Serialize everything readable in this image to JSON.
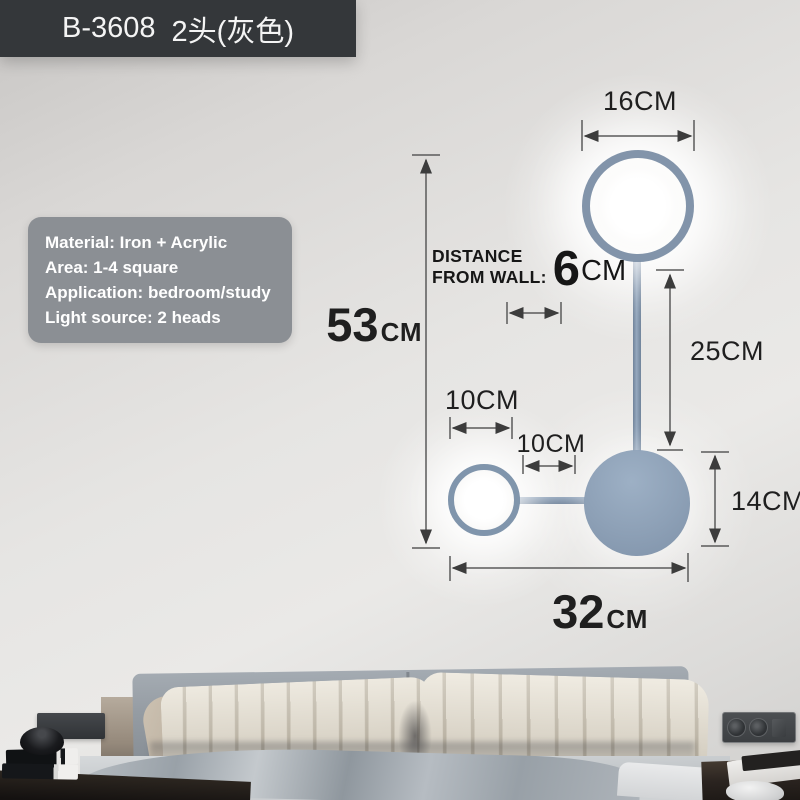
{
  "badge": {
    "model": "B-3608",
    "variant": "2头(灰色)"
  },
  "info_box": {
    "material": "Material: Iron + Acrylic",
    "area": "Area: 1-4 square",
    "application": "Application: bedroom/study",
    "light_source": "Light source: 2 heads"
  },
  "dimensions": {
    "top_circle_diameter": {
      "value": "16",
      "unit": "CM"
    },
    "total_height": {
      "value": "53",
      "unit": "CM"
    },
    "wall_distance": {
      "label_line1": "DISTANCE",
      "label_line2": "FROM WALL:",
      "value": "6",
      "unit": "CM"
    },
    "stem_length": {
      "value": "25",
      "unit": "CM"
    },
    "small_circle_diameter": {
      "value": "10",
      "unit": "CM"
    },
    "circle_spacing": {
      "value": "10",
      "unit": "CM"
    },
    "bottom_circle_diameter": {
      "value": "14",
      "unit": "CM"
    },
    "total_width": {
      "value": "32",
      "unit": "CM"
    }
  },
  "colors": {
    "lamp_frame": "#8295ab",
    "badge_background": "#34373a",
    "info_box_background": "#8b8f94",
    "dimension_text": "#1f1f1f",
    "wall": "#e2e1df"
  }
}
